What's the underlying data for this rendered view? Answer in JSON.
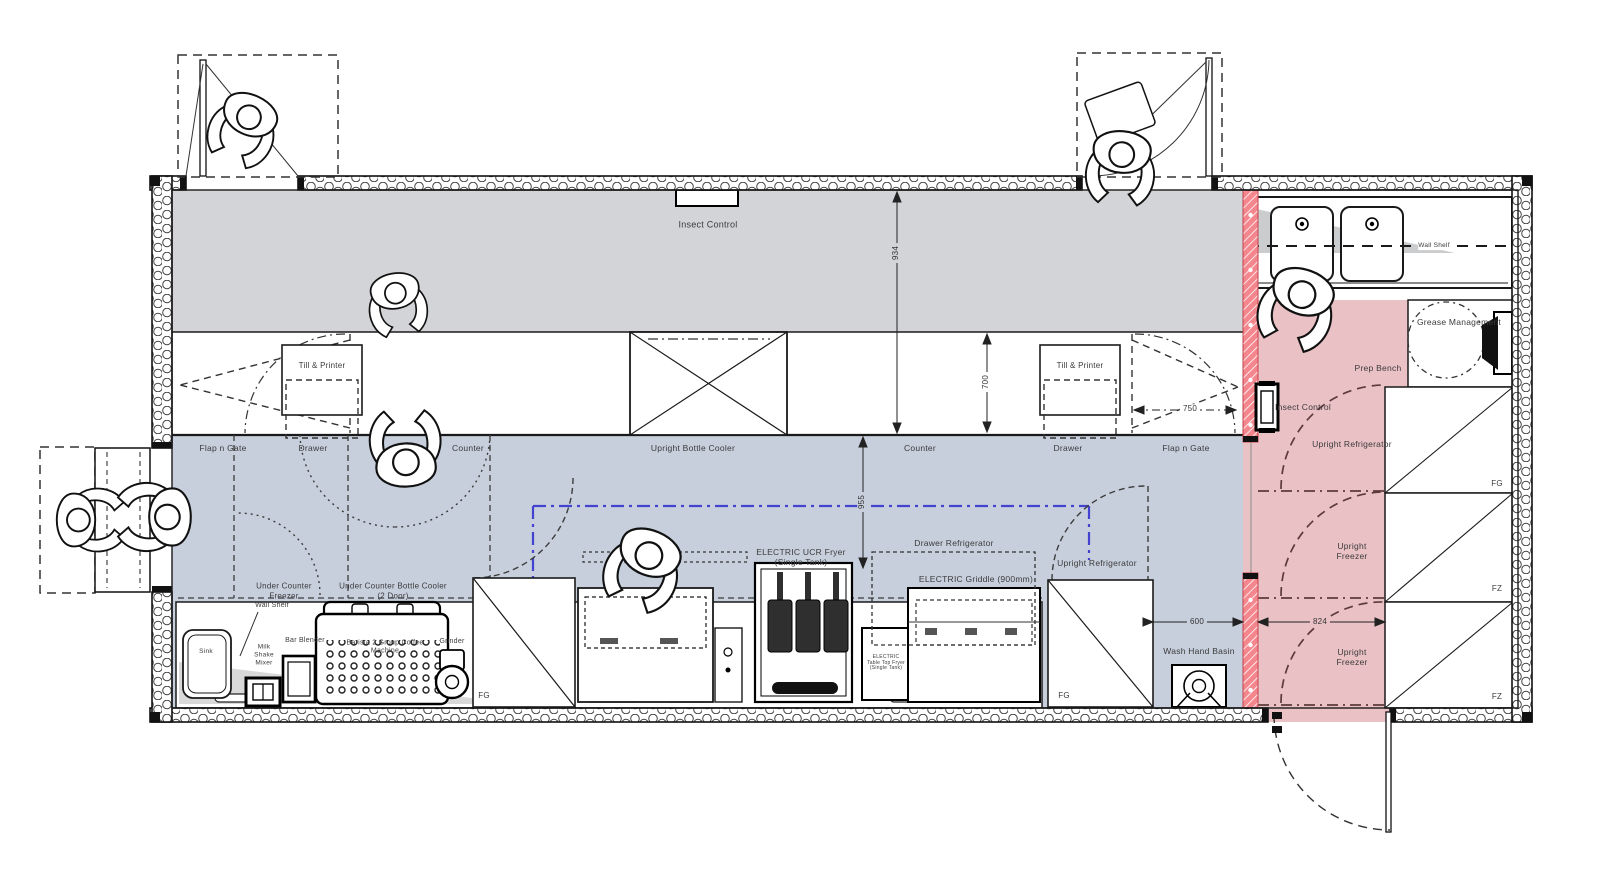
{
  "title": "Container bar and kitchen floor plan",
  "colors": {
    "gray_floor": "#d2d4d7",
    "blue_floor": "#c7cfdd",
    "pink_floor": "#eac1c5",
    "screen_pink": "#f4868d",
    "line": "#1a1a1a",
    "dash_blue": "#4343cf",
    "arc_maroon": "#5d3b3b"
  },
  "labels": {
    "insect_control_top": "Insect Control",
    "till_printer": "Till & Printer",
    "flap_n_gate": "Flap n Gate",
    "drawer": "Drawer",
    "counter": "Counter",
    "upright_bottle_cooler": "Upright Bottle Cooler",
    "under_counter_freezer": "Under Counter Freezer",
    "under_counter_bottle_cooler": "Under Counter Bottle Cooler (2 Door)",
    "wall_shelf": "Wall Shelf",
    "sink": "Sink",
    "milk_shake_mixer": "Milk Shake Mixer",
    "bar_blender": "Bar Blender",
    "coffee_machine": "Barista 2 Group Coffee Machine",
    "grinder": "Grinder",
    "electric_ucr_fryer": "ELECTRIC UCR Fryer (Single Tank)",
    "drawer_refrigerator": "Drawer Refrigerator",
    "electric_griddle": "ELECTRIC Griddle (900mm)",
    "table_top_fryer": "ELECTRIC Table Top Fryer (Single Tank)",
    "upright_refrigerator": "Upright Refrigerator",
    "upright_freezer": "Upright Freezer",
    "wash_hand_basin": "Wash Hand Basin",
    "prep_bench": "Prep Bench",
    "insect_control_right": "Insect Control",
    "grease_management": "Grease Management",
    "tag_fg": "FG",
    "tag_fz": "FZ"
  },
  "dimensions": {
    "walkway_depth": "934",
    "counter_depth": "700",
    "aisle_width": "955",
    "gate_width": "750",
    "basin_gap": "600",
    "corridor_width": "824"
  }
}
